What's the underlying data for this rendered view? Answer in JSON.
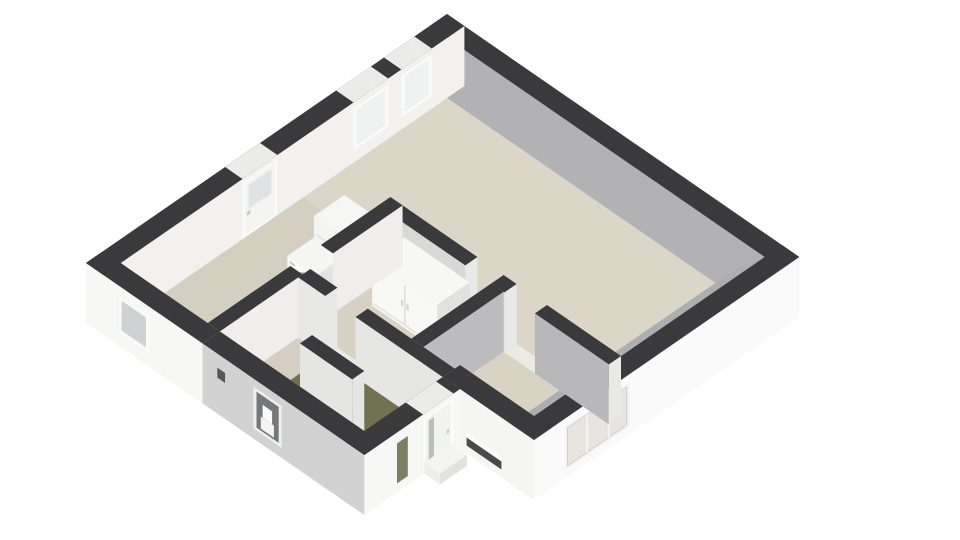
{
  "meta": {
    "view": "floorplan-3d-render",
    "background": "#ffffff",
    "visible_text": []
  },
  "palette": {
    "wall_top": "#3a3a3c",
    "wall_outer_white": "#f6f6f4",
    "wall_inner_gray": "#b2b2b4",
    "floor_beige": "#d9d3c5",
    "floor_green": "#6f7352",
    "furniture_white": "#f8f8f6",
    "glass_gray": "#ced2d3",
    "glass_green": "#7b8160"
  },
  "scene": {
    "proj": {
      "ox": 447,
      "oy": 98,
      "ax": 43.5,
      "ay": 30
    },
    "wallH": 60,
    "items": [
      {
        "n": "floor-living-room",
        "k": "floor",
        "r": [
          0,
          0,
          7.3,
          3.3
        ],
        "f": "#dcd6c8"
      },
      {
        "n": "floor-dining-area",
        "k": "floor",
        "r": [
          2.28,
          3.3,
          4.6,
          5.7
        ],
        "f": "#d8d2c4"
      },
      {
        "n": "floor-kitchen",
        "k": "floor",
        "r": [
          0,
          3.3,
          2.0,
          7.5
        ],
        "f": "#d5cfc1"
      },
      {
        "n": "floor-closet",
        "k": "floor",
        "r": [
          2.28,
          5.7,
          2.9,
          6.5
        ],
        "f": "#d5cfc1"
      },
      {
        "n": "floor-bathroom",
        "k": "floor",
        "r": [
          2.28,
          6.5,
          4.6,
          7.5
        ],
        "f": "#d5cfc1"
      },
      {
        "n": "floor-entry-hall-green",
        "k": "floor",
        "r": [
          2.9,
          5.7,
          5.6,
          6.5
        ],
        "f": "#6f7352"
      },
      {
        "n": "floor-bedroom",
        "k": "floor",
        "r": [
          4.6,
          3.3,
          7.3,
          5.3
        ],
        "f": "#d9d3c5"
      },
      {
        "n": "threshold-bedroom-door",
        "k": "floor",
        "r": [
          4.9,
          3.3,
          5.6,
          3.58
        ],
        "f": "#eceae4"
      },
      {
        "n": "threshold-hall-opening",
        "k": "floor",
        "r": [
          2.9,
          5.42,
          3.6,
          5.7
        ],
        "f": "#eceae4"
      },
      {
        "n": "threshold-bathroom-door",
        "k": "floor",
        "r": [
          2.7,
          6.5,
          3.4,
          6.78
        ],
        "f": "#eceae4"
      },
      {
        "n": "threshold-kitchen-door",
        "k": "floor",
        "r": [
          2.0,
          4.9,
          2.28,
          5.6
        ],
        "f": "#eceae4"
      },
      {
        "n": "kitchen-floor-mat",
        "k": "floor",
        "r": [
          0.28,
          6.5,
          1.0,
          7.38
        ],
        "f": "#f3f2ee"
      },
      {
        "n": "wall-north-exterior",
        "k": "wall",
        "r": [
          -0.4,
          -0.4,
          7.7,
          0
        ],
        "f": {
          "top": "#3a3a3c",
          "py": "#b2b2b4"
        }
      },
      {
        "n": "wall-east-exterior",
        "k": "wall",
        "r": [
          7.3,
          -0.4,
          7.7,
          5.7
        ],
        "f": {
          "top": "#3a3a3c",
          "px": "#fafafa",
          "py": "#f0f0ee"
        },
        "m": [
          {
            "t": "q",
            "p": "x",
            "a": 3.5,
            "b": 5.0,
            "z1": 8,
            "z2": 52,
            "f": "#f4f4f4",
            "n": "bedroom-window-frame"
          },
          {
            "t": "q",
            "p": "x",
            "a": 3.57,
            "b": 4.93,
            "z1": 11,
            "z2": 49,
            "f": "#e7e5e0",
            "s": "#cfcdc8",
            "w": 1,
            "n": "bedroom-window-glass"
          },
          {
            "t": "vline",
            "p": "x",
            "at": 3.98,
            "z1": 11,
            "z2": 49,
            "s": "#f4f4f4",
            "w": 2
          },
          {
            "t": "vline",
            "p": "x",
            "at": 4.48,
            "z1": 11,
            "z2": 49,
            "s": "#f4f4f4",
            "w": 2
          }
        ]
      },
      {
        "n": "wall-east-inner-face-hint",
        "k": "screen",
        "pts": [
          [
            7.3,
            0.05,
            60
          ],
          [
            7.3,
            5.5,
            60
          ]
        ],
        "off": [
          -26,
          10
        ],
        "f": "#aeaeb0"
      },
      {
        "n": "wall-west-exterior",
        "k": "wall",
        "r": [
          -0.4,
          -0.4,
          0,
          7.9
        ],
        "f": {
          "top": "#3a3a3c",
          "px": "#f2f1ee",
          "py": "#f6f6f4"
        },
        "m": [
          {
            "t": "ts",
            "a": 0.35,
            "b": 1.05,
            "f": "#ebebe9"
          },
          {
            "t": "q",
            "p": "x",
            "a": 0.35,
            "b": 1.05,
            "z1": 12,
            "z2": 54,
            "f": "#fafafa",
            "n": "living-window-1-frame"
          },
          {
            "t": "q",
            "p": "x",
            "a": 0.42,
            "b": 0.98,
            "z1": 15,
            "z2": 51,
            "f": "#eff1f1",
            "n": "living-window-1-glass"
          },
          {
            "t": "ts",
            "a": 1.35,
            "b": 2.15,
            "f": "#ebebe9"
          },
          {
            "t": "q",
            "p": "x",
            "a": 1.35,
            "b": 2.15,
            "z1": 12,
            "z2": 54,
            "f": "#fafafa",
            "n": "living-window-2-frame"
          },
          {
            "t": "q",
            "p": "x",
            "a": 1.42,
            "b": 2.08,
            "z1": 15,
            "z2": 51,
            "f": "#eff1f1",
            "n": "living-window-2-glass"
          },
          {
            "t": "ts",
            "a": 3.9,
            "b": 4.7,
            "f": "#ebebe9"
          },
          {
            "t": "q",
            "p": "x",
            "a": 3.9,
            "b": 4.7,
            "z1": 0,
            "z2": 56,
            "f": "#fafafa",
            "n": "back-door-frame"
          },
          {
            "t": "q",
            "p": "x",
            "a": 3.96,
            "b": 4.64,
            "z1": 2,
            "z2": 54,
            "f": "#f4f4f2",
            "n": "back-door-panel"
          },
          {
            "t": "q",
            "p": "x",
            "a": 4.04,
            "b": 4.56,
            "z1": 26,
            "z2": 50,
            "f": "#dfe3e3",
            "n": "back-door-glass"
          },
          {
            "t": "q",
            "p": "x",
            "a": 4.52,
            "b": 4.6,
            "z1": 20,
            "z2": 24,
            "f": "#c9c9c7",
            "n": "back-door-handle"
          }
        ]
      },
      {
        "n": "wall-living-south-a",
        "k": "wall",
        "r": [
          2.28,
          3.3,
          4.0,
          3.58
        ],
        "f": {
          "top": "#3a3a3c",
          "py": "#d8d8d6",
          "px": "#e9e9e7"
        }
      },
      {
        "n": "wall-living-south-b",
        "k": "wall",
        "r": [
          4.6,
          3.3,
          4.9,
          3.58
        ],
        "f": {
          "top": "#3a3a3c",
          "py": "#d8d8d6",
          "px": "#e9e9e7"
        }
      },
      {
        "n": "wall-bedroom-north",
        "k": "wall",
        "r": [
          5.6,
          3.3,
          7.3,
          3.58
        ],
        "f": {
          "top": "#3a3a3c",
          "py": "#b8b8ba",
          "px": "#e9e9e7"
        }
      },
      {
        "n": "fridge-cabinet",
        "k": "box",
        "r": [
          1.22,
          3.58,
          1.98,
          4.28
        ],
        "h": 47,
        "f": {
          "top": "#f6f6f4",
          "py": "#f4f4f2",
          "px": "#e0e0de"
        },
        "m": [
          {
            "t": "hline",
            "p": "y",
            "a": 1.26,
            "b": 1.94,
            "cz": 30,
            "s": "#e2e2e0",
            "w": 1.5
          }
        ]
      },
      {
        "n": "washing-machine",
        "k": "box",
        "r": [
          1.28,
          4.3,
          1.94,
          4.95
        ],
        "h": 29,
        "f": {
          "top": "#f5f5f3",
          "py": "#fbfbf9",
          "px": "#e3e3e1"
        },
        "m": [
          {
            "t": "circle",
            "p": "y",
            "at": 1.61,
            "cz": 13,
            "r": 8.5,
            "f": "#e9e9e7",
            "s": "#a8a8aa",
            "w": 2,
            "n": "washer-door-ring"
          },
          {
            "t": "circle",
            "p": "y",
            "at": 1.61,
            "cz": 13,
            "r": 4,
            "f": "#c7c7c9",
            "n": "washer-door-glass"
          },
          {
            "t": "q",
            "p": "y",
            "a": 1.33,
            "b": 1.45,
            "z1": 23,
            "z2": 26,
            "f": "#cfcfcd",
            "n": "washer-dial"
          }
        ]
      },
      {
        "n": "wardrobe",
        "k": "box",
        "r": [
          2.6,
          3.58,
          4.1,
          4.32
        ],
        "h": 46,
        "f": {
          "top": "#f7f7f5",
          "py": "#f8f8f6",
          "px": "#e1e1df"
        },
        "m": [
          {
            "t": "vline",
            "p": "y",
            "at": 3.35,
            "z1": 3,
            "z2": 43,
            "s": "#dbdbd9",
            "w": 1.5
          },
          {
            "t": "q",
            "p": "y",
            "a": 3.26,
            "b": 3.31,
            "z1": 20,
            "z2": 26,
            "f": "#d4d4d2",
            "n": "wardrobe-handle-left"
          },
          {
            "t": "q",
            "p": "y",
            "a": 3.39,
            "b": 3.44,
            "z1": 20,
            "z2": 26,
            "f": "#d4d4d2",
            "n": "wardrobe-handle-right"
          },
          {
            "t": "hline",
            "p": "y",
            "a": 2.64,
            "b": 4.06,
            "cz": 3,
            "s": "#e0e0de",
            "w": 1.5
          }
        ]
      },
      {
        "n": "wall-bedroom-west",
        "k": "wall",
        "r": [
          4.6,
          3.58,
          4.88,
          5.42
        ],
        "f": {
          "top": "#3a3a3c",
          "px": "#bcbcbe",
          "py": "#eaeae8"
        }
      },
      {
        "n": "wall-kitchen-east-a",
        "k": "wall",
        "r": [
          2.0,
          3.3,
          2.28,
          4.9
        ],
        "f": {
          "top": "#3a3a3c",
          "px": "#efeeec"
        }
      },
      {
        "n": "wall-kitchen-east-b",
        "k": "wall",
        "r": [
          2.0,
          5.6,
          2.28,
          7.5
        ],
        "f": {
          "top": "#3a3a3c",
          "px": "#efeeec",
          "py": "#f2f2f0"
        }
      },
      {
        "n": "wall-hall-north-a",
        "k": "wall",
        "r": [
          2.28,
          5.42,
          2.9,
          5.7
        ],
        "f": {
          "top": "#3a3a3c",
          "py": "#e8e8e6",
          "px": "#e8e8e6"
        }
      },
      {
        "n": "wall-hall-north-b",
        "k": "wall",
        "r": [
          3.6,
          5.42,
          5.6,
          5.7
        ],
        "f": {
          "top": "#3a3a3c",
          "py": "#e6e6e4"
        }
      },
      {
        "n": "wall-bedroom-south-exterior",
        "k": "wall",
        "r": [
          5.6,
          5.3,
          7.7,
          5.7
        ],
        "f": {
          "top": "#3a3a3c",
          "py": "#f5f5f3"
        },
        "m": [
          {
            "t": "q",
            "p": "y",
            "a": 6.15,
            "b": 6.95,
            "z1": 16,
            "z2": 21,
            "f": "#fdfdfb",
            "n": "letterbox-sill"
          },
          {
            "t": "q",
            "p": "y",
            "a": 6.15,
            "b": 6.95,
            "z1": 8,
            "z2": 16,
            "f": "#4a4a4c",
            "n": "letterbox-slot"
          }
        ]
      },
      {
        "n": "wall-front-entrance",
        "k": "wall",
        "r": [
          5.6,
          5.7,
          6.0,
          7.9
        ],
        "f": {
          "top": "#3a3a3c",
          "px": "#f7f7f5",
          "py": "#f4f4f2"
        },
        "m": [
          {
            "t": "ts",
            "a": 5.85,
            "b": 6.55,
            "f": "#ebebe9"
          },
          {
            "t": "q",
            "p": "x",
            "a": 5.85,
            "b": 6.55,
            "z1": 0,
            "z2": 56,
            "f": "#fbfbf9",
            "n": "front-door-frame"
          },
          {
            "t": "q",
            "p": "x",
            "a": 5.92,
            "b": 6.48,
            "z1": 2,
            "z2": 53,
            "f": "#f2f2f0",
            "n": "front-door-panel"
          },
          {
            "t": "q",
            "p": "x",
            "a": 6.3,
            "b": 6.42,
            "z1": 6,
            "z2": 50,
            "f": "#b9bfba",
            "n": "front-door-glass"
          },
          {
            "t": "q",
            "p": "x",
            "a": 5.95,
            "b": 6.01,
            "z1": 24,
            "z2": 28,
            "f": "#c9c9c7",
            "n": "front-door-handle"
          },
          {
            "t": "q",
            "p": "x",
            "a": 6.85,
            "b": 7.2,
            "z1": 6,
            "z2": 52,
            "f": "#f6f6f4",
            "n": "sidelight-frame"
          },
          {
            "t": "q",
            "p": "x",
            "a": 6.9,
            "b": 7.15,
            "z1": 9,
            "z2": 49,
            "f": "#7b8160",
            "n": "sidelight-glass"
          }
        ]
      },
      {
        "n": "front-doorstep",
        "k": "box",
        "r": [
          6.0,
          5.9,
          6.36,
          6.52
        ],
        "h": 11,
        "f": {
          "top": "#f4f4f2",
          "py": "#ededeb",
          "px": "#e2e2e0"
        }
      },
      {
        "n": "wall-bathroom-north",
        "k": "wall",
        "r": [
          3.4,
          6.5,
          4.6,
          6.78
        ],
        "f": {
          "top": "#3a3a3c",
          "py": "#e5e5e3",
          "px": "#e5e5e3"
        }
      },
      {
        "n": "wall-south-exterior-kitchen",
        "k": "wall",
        "r": [
          -0.4,
          7.5,
          2.28,
          7.9
        ],
        "f": {
          "top": "#3a3a3c",
          "py": "#f7f7f5",
          "px": "#efefed"
        },
        "m": [
          {
            "t": "q",
            "p": "y",
            "a": 0.35,
            "b": 1.05,
            "z1": 14,
            "z2": 50,
            "f": "#fafaf8",
            "n": "kitchen-window-frame"
          },
          {
            "t": "q",
            "p": "y",
            "a": 0.42,
            "b": 0.98,
            "z1": 17,
            "z2": 47,
            "f": "#ced2d3",
            "n": "kitchen-window-glass"
          }
        ]
      },
      {
        "n": "wall-south-exterior-bathroom",
        "k": "wall",
        "r": [
          2.28,
          7.5,
          6.0,
          7.9
        ],
        "f": {
          "top": "#3a3a3c",
          "py": "#d2d2d2"
        },
        "m": [
          {
            "t": "q",
            "p": "y",
            "a": 3.45,
            "b": 4.1,
            "z1": 10,
            "z2": 52,
            "f": "#efefed",
            "n": "bathroom-window-frame"
          },
          {
            "t": "q",
            "p": "y",
            "a": 3.52,
            "b": 4.03,
            "z1": 13,
            "z2": 49,
            "f": "#75787a",
            "n": "bathroom-window-glass"
          },
          {
            "t": "q",
            "p": "y",
            "a": 3.62,
            "b": 3.92,
            "z1": 15,
            "z2": 27,
            "f": "#f4f4f2",
            "n": "toilet-bowl-glimpse"
          },
          {
            "t": "q",
            "p": "y",
            "a": 3.66,
            "b": 3.88,
            "z1": 27,
            "z2": 40,
            "f": "#fbfbf9",
            "n": "toilet-cistern-glimpse"
          },
          {
            "t": "q",
            "p": "y",
            "a": 2.62,
            "b": 2.8,
            "z1": 36,
            "z2": 46,
            "f": "#58585a",
            "n": "exterior-vent"
          }
        ]
      }
    ]
  }
}
